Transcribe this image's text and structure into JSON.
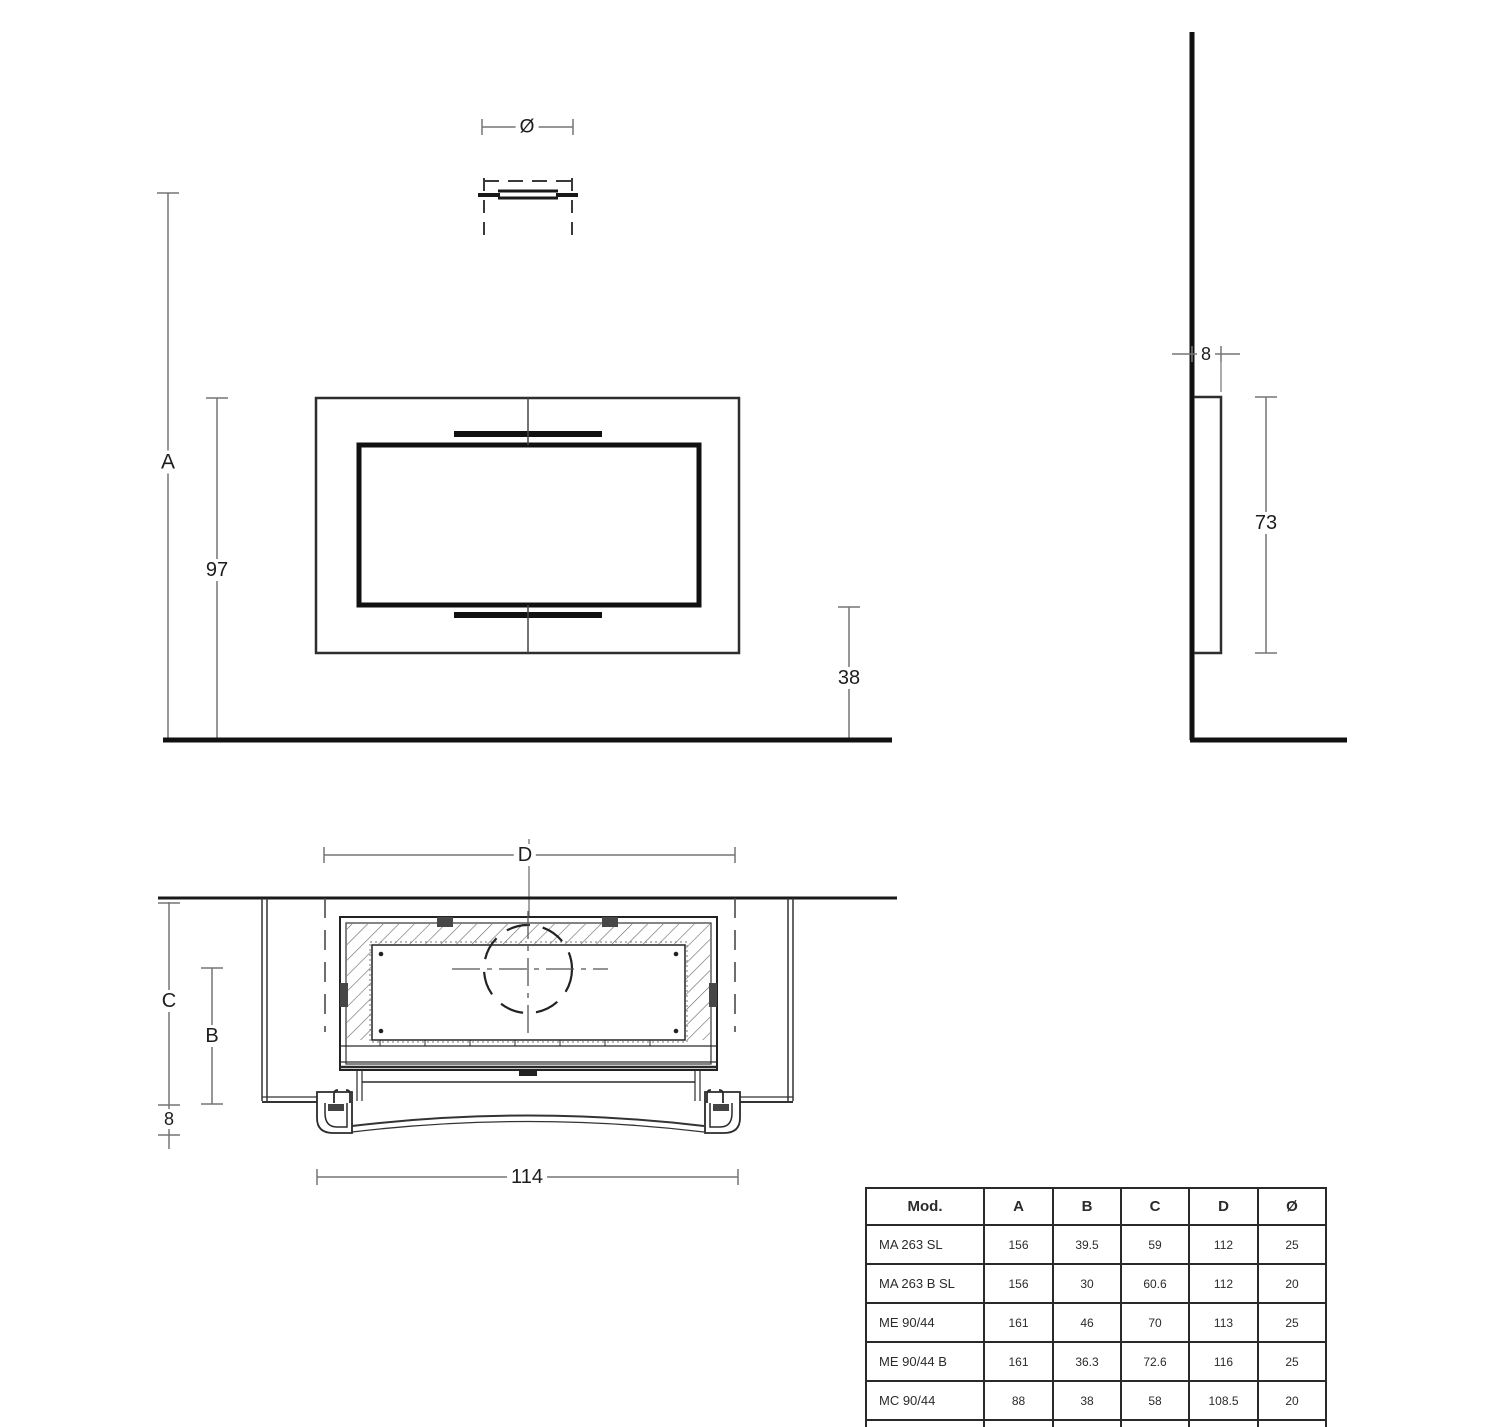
{
  "front_view": {
    "dim_diameter": "Ø",
    "dim_total_height": "A",
    "dim_height_97": "97",
    "dim_bottom_38": "38"
  },
  "side_view": {
    "dim_depth_8": "8",
    "dim_height_73": "73"
  },
  "plan_view": {
    "dim_niche_width": "D",
    "dim_depth_c": "C",
    "dim_depth_b": "B",
    "dim_offset_8": "8",
    "dim_width_114": "114"
  },
  "table": {
    "headers": [
      "Mod.",
      "A",
      "B",
      "C",
      "D",
      "Ø"
    ],
    "rows": [
      [
        "MA 263 SL",
        "156",
        "39.5",
        "59",
        "112",
        "25"
      ],
      [
        "MA 263 B SL",
        "156",
        "30",
        "60.6",
        "112",
        "20"
      ],
      [
        "ME 90/44",
        "161",
        "46",
        "70",
        "113",
        "25"
      ],
      [
        "ME 90/44 B",
        "161",
        "36.3",
        "72.6",
        "116",
        "25"
      ],
      [
        "MC 90/44",
        "88",
        "38",
        "58",
        "108.5",
        "20"
      ],
      [
        "IG 90",
        "89.5",
        "25.5",
        "43",
        "103",
        "15"
      ]
    ]
  }
}
